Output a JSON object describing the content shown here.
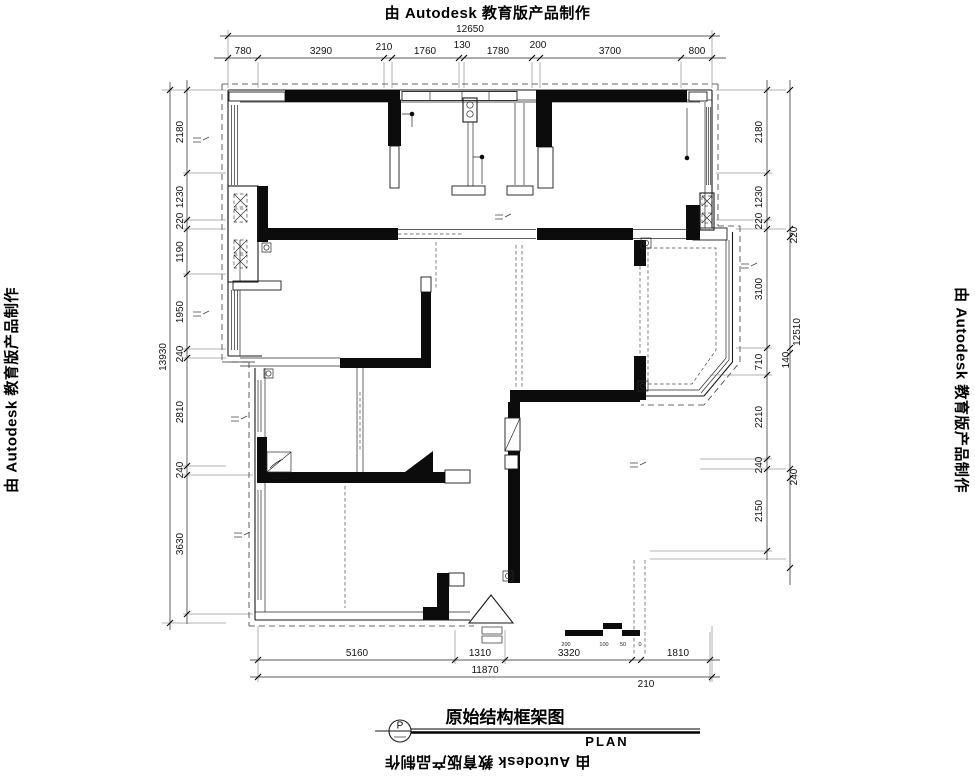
{
  "stamps": {
    "text": "由 Autodesk 教育版产品制作"
  },
  "title_block": {
    "bubble_letter": "P",
    "title": "原始结构框架图",
    "plan_label": "PLAN"
  },
  "dims": {
    "top": {
      "overall": "12650",
      "segments": [
        "780",
        "3290",
        "210",
        "1760",
        "130",
        "1780",
        "200",
        "3700",
        "800"
      ]
    },
    "left": {
      "overall": "13930",
      "segments": [
        "2180",
        "1230",
        "220",
        "1190",
        "1950",
        "240",
        "2810",
        "240",
        "3630"
      ]
    },
    "right": {
      "inner": [
        "2180",
        "1230",
        "220",
        "3100",
        "710",
        "2210",
        "240",
        "2150"
      ],
      "outer": [
        "220",
        "12510",
        "140",
        "240"
      ]
    },
    "bottom": {
      "overall": "11870",
      "inset": "210",
      "segments": [
        "5160",
        "1310",
        "3320",
        "1810"
      ]
    }
  },
  "scale_bar": {
    "labels": [
      "200",
      "100",
      "50",
      "0"
    ]
  }
}
